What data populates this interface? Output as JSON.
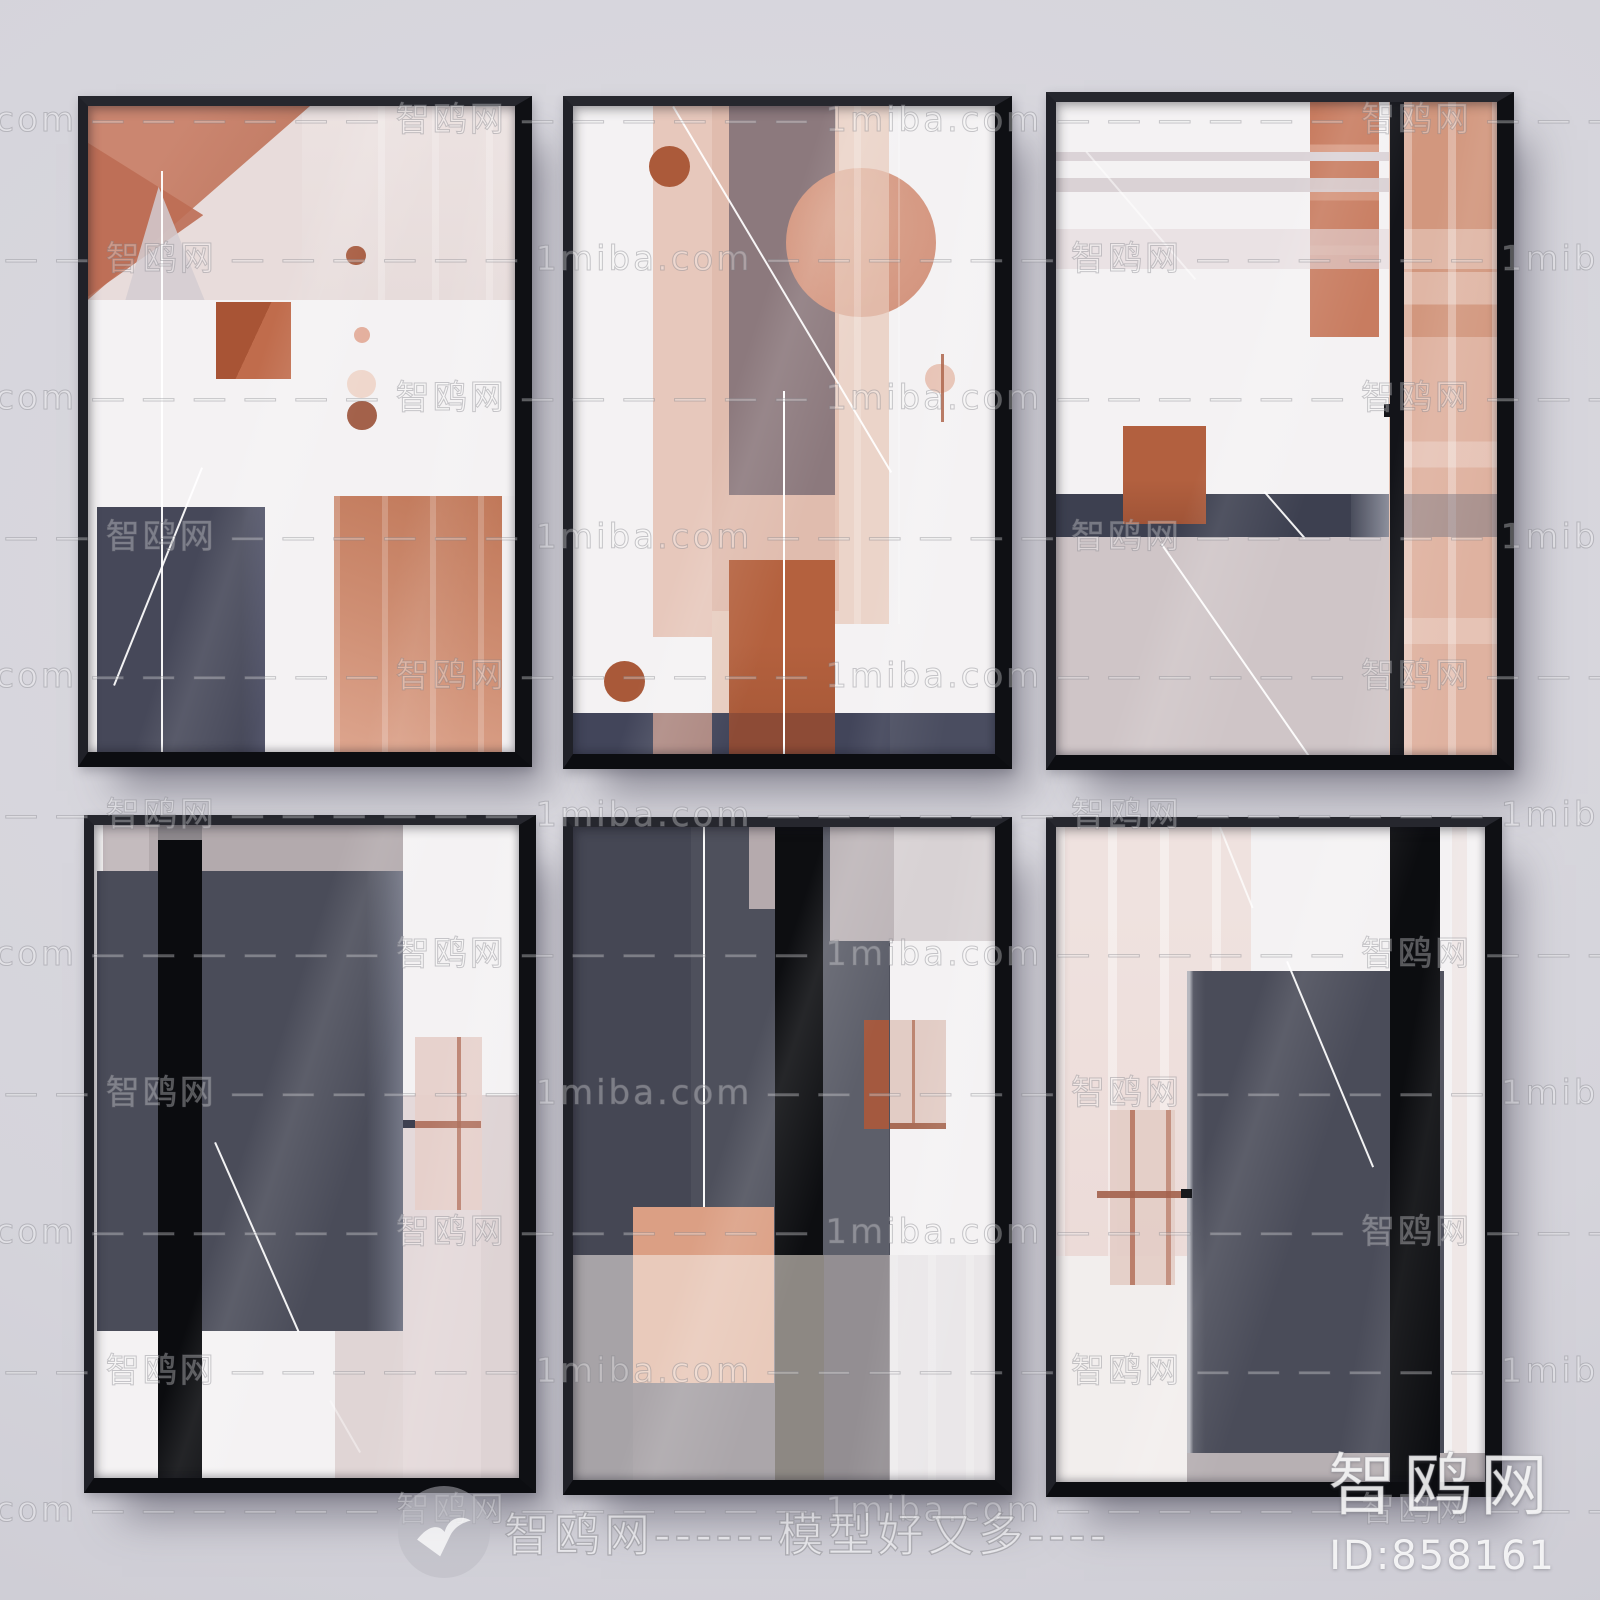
{
  "scene": {
    "description": "Six black-framed abstract geometric posters hung in a 2x3 grid on a pale wall",
    "grid": "2 rows x 3 columns"
  },
  "watermark": {
    "site": "1miba.com",
    "brand": "智鸥网",
    "dashes": "— — — — — —",
    "slogan": "模型好又多",
    "bottom_line": "智鸥网------模型好又多----",
    "id_label": "ID:858161",
    "rows": 11
  },
  "palette": {
    "wall": "#d6d5dc",
    "frame": "#1d1e24",
    "frame_dark": "#101116",
    "art_white": "#f4f2f3",
    "charcoal": "#4a4c59",
    "navy": "#464859",
    "ink_black": "#0d0e11",
    "terracotta": "#ad5a3c",
    "rust": "#b4613e",
    "salmon": "#d89b87",
    "salmon_light": "#e3c2b4",
    "pink_pale": "#ecdbd8",
    "mauve": "#8c797d",
    "mauve_gray": "#b3aaad",
    "greige": "#cfc5c7",
    "band_dark": "#3d4050"
  },
  "frames": [
    {
      "id": 1,
      "position": "top-left"
    },
    {
      "id": 2,
      "position": "top-center"
    },
    {
      "id": 3,
      "position": "top-right"
    },
    {
      "id": 4,
      "position": "bottom-left"
    },
    {
      "id": 5,
      "position": "bottom-center"
    },
    {
      "id": 6,
      "position": "bottom-right"
    }
  ]
}
